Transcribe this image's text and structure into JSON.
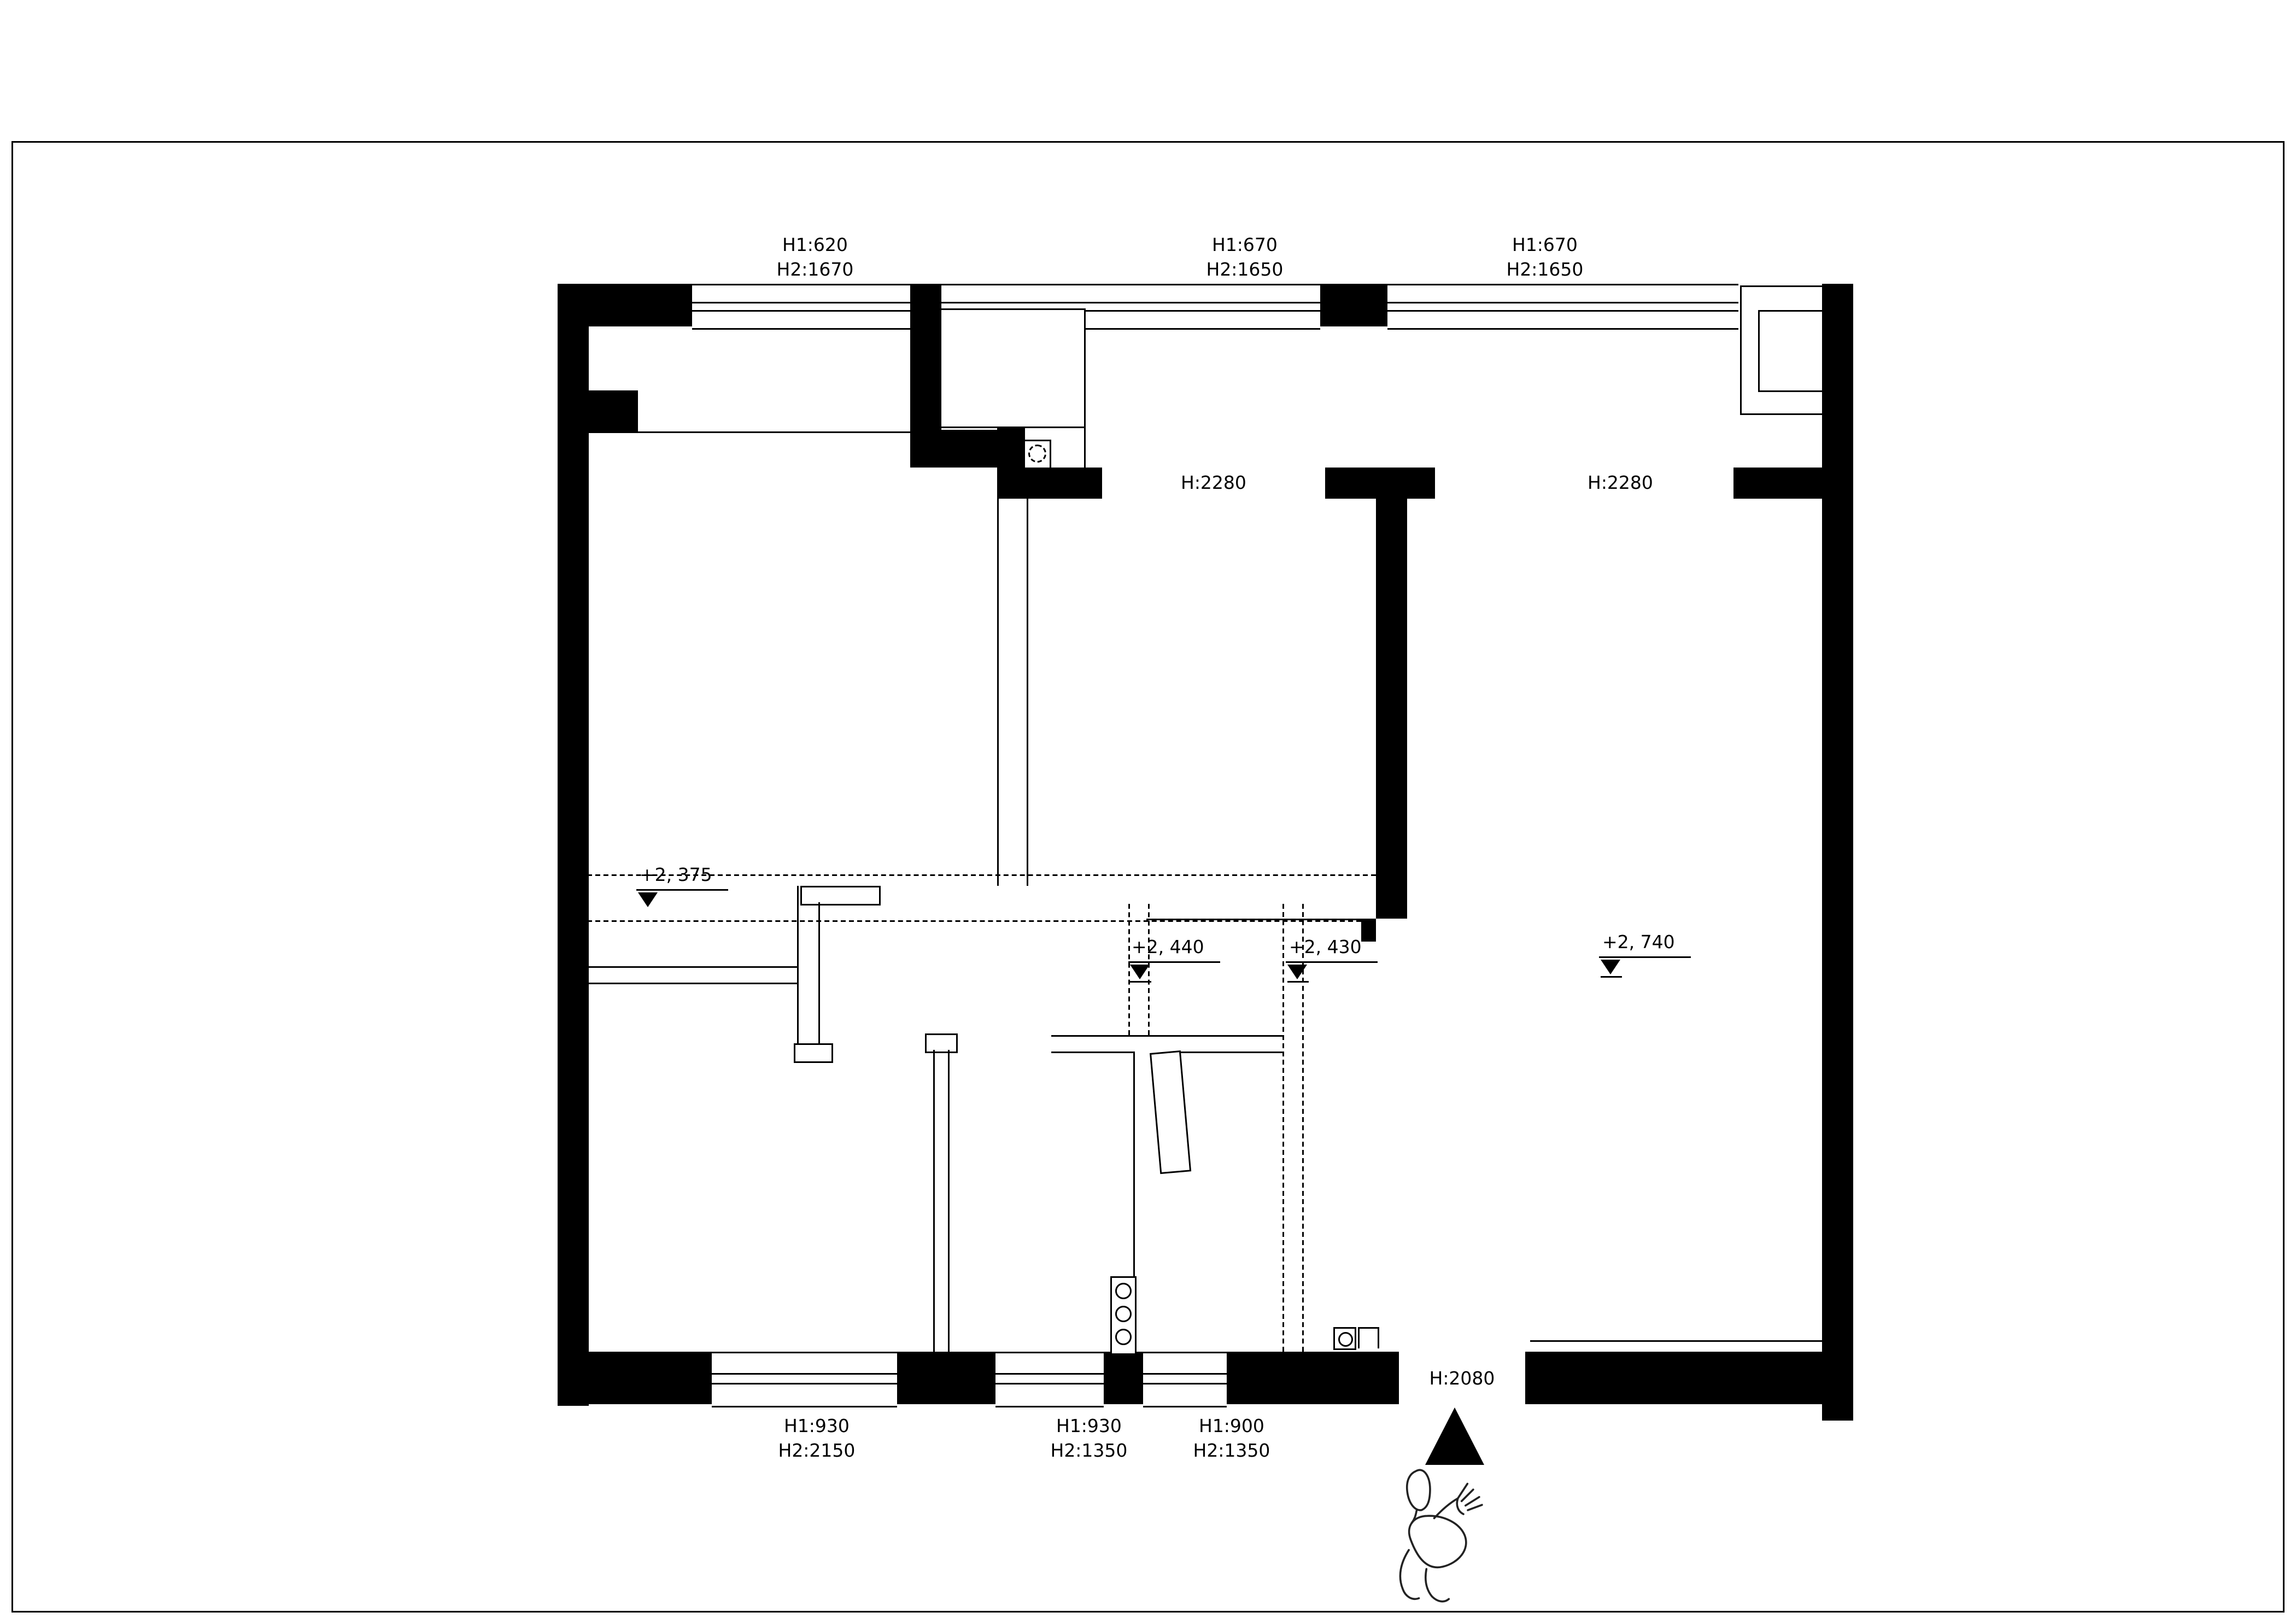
{
  "drawing": {
    "top_window_labels": [
      {
        "h1": "H1:620",
        "h2": "H2:1670"
      },
      {
        "h1": "H1:670",
        "h2": "H2:1650"
      },
      {
        "h1": "H1:670",
        "h2": "H2:1650"
      }
    ],
    "bottom_window_labels": [
      {
        "h1": "H1:930",
        "h2": "H2:2150"
      },
      {
        "h1": "H1:930",
        "h2": "H2:1350"
      },
      {
        "h1": "H1:900",
        "h2": "H2:1350"
      }
    ],
    "interior_opening_labels": [
      "H:2280",
      "H:2280"
    ],
    "entrance_label": "H:2080",
    "level_markers": [
      "+2, 375",
      "+2, 440",
      "+2, 430",
      "+2, 740"
    ],
    "colors": {
      "ink": "#000000",
      "paper": "#ffffff"
    }
  }
}
